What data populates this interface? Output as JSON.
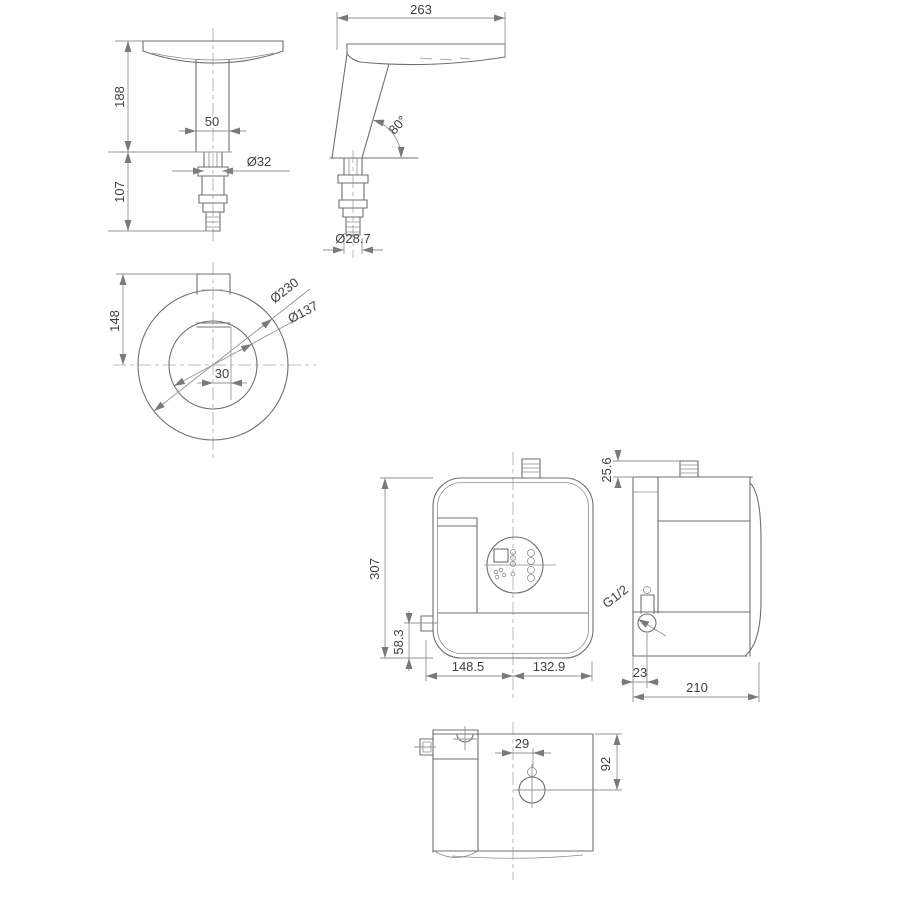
{
  "colors": {
    "background": "#ffffff",
    "geometry_line": "#6f6f6f",
    "dimension_line": "#939393",
    "text": "#3d4043"
  },
  "views": {
    "faucet_front": {
      "dim_height_upper": "188",
      "dim_stem_width": "50",
      "dim_shank_diameter": "Ø32",
      "dim_height_lower": "107"
    },
    "faucet_side": {
      "dim_reach": "263",
      "dim_angle": "80°",
      "dim_inlet_diameter": "Ø28.7"
    },
    "faucet_top": {
      "dim_center_offset": "148",
      "dim_outer_diameter": "Ø230",
      "dim_inner_diameter": "Ø137",
      "dim_stem_offset": "30"
    },
    "heater_front": {
      "dim_height": "307",
      "dim_inlet_height": "58.3",
      "dim_width_left": "148.5",
      "dim_width_right": "132.9"
    },
    "heater_side": {
      "dim_stub_height": "25.6",
      "thread_label": "G1/2",
      "dim_inlet_offset": "23",
      "dim_depth": "210"
    },
    "heater_bottom": {
      "dim_port_offset": "29",
      "dim_port_depth": "92"
    }
  }
}
